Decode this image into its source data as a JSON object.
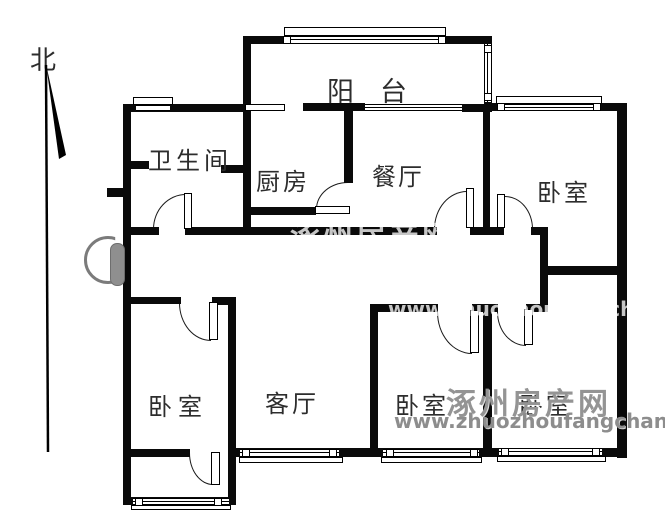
{
  "compass": {
    "label": "北"
  },
  "rooms": {
    "balcony": "阳台",
    "bathroom": "卫生间",
    "kitchen": "厨房",
    "dining": "餐厅",
    "bedroom_top_right": "卧室",
    "bedroom_bottom_left": "卧室",
    "living": "客厅",
    "bedroom_bottom_middle": "卧室",
    "bedroom_bottom_right": "卧室"
  },
  "watermark": {
    "site_name": "涿州房产网",
    "site_url": "www.zhuozhoufangchan.com"
  },
  "colors": {
    "wall": "#0a0a0a",
    "entry_door_gray": "#8f8f8f",
    "watermark_gray": "#949494"
  }
}
